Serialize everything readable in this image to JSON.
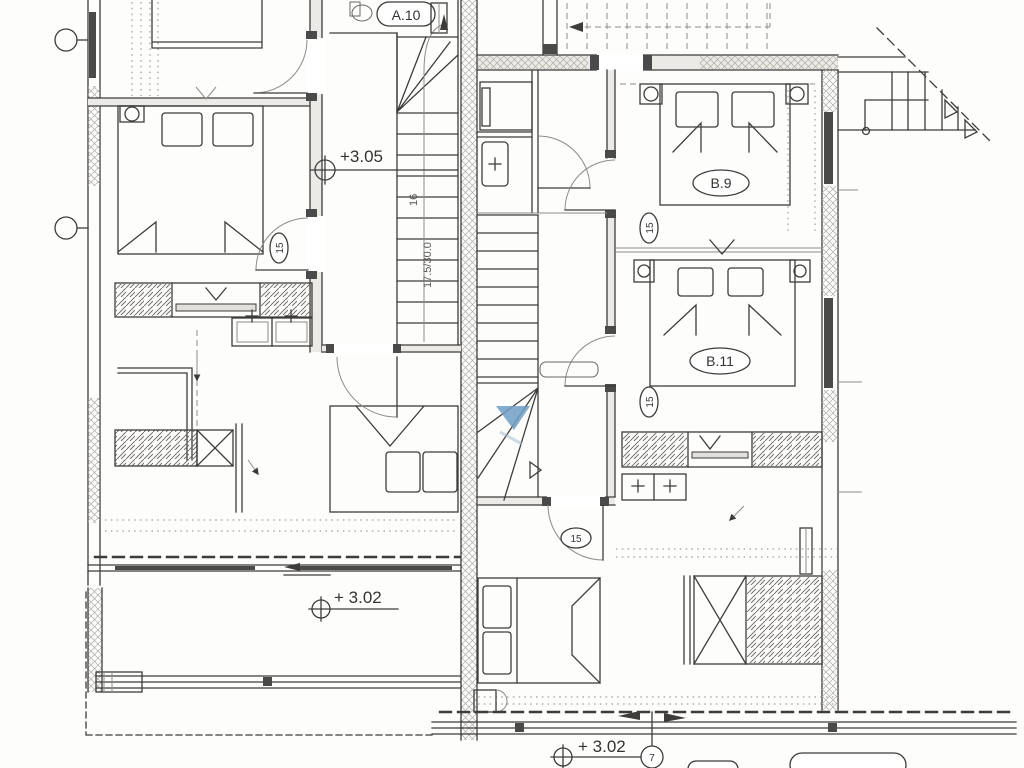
{
  "plan": {
    "rooms": {
      "a10": "A.10",
      "b9": "B.9",
      "b11": "B.11"
    },
    "levels": {
      "landing": "+3.05",
      "terrace_left": "+ 3.02",
      "terrace_right": "+ 3.02"
    },
    "stair": {
      "risers": "16",
      "note": "17.5/30.0"
    },
    "doors": {
      "a_bedroom": "15",
      "b9": "15",
      "b11": "15",
      "b_bottom": "15"
    },
    "markers": {
      "terrace_detail": "7"
    },
    "colors": {
      "line": "#3e3c3a",
      "light_line": "#8f8b86",
      "window": "#4a4a4a",
      "wall_fill": "#eceae6",
      "stair_accent": "#6f9ec4",
      "paper": "#ffffff"
    }
  }
}
